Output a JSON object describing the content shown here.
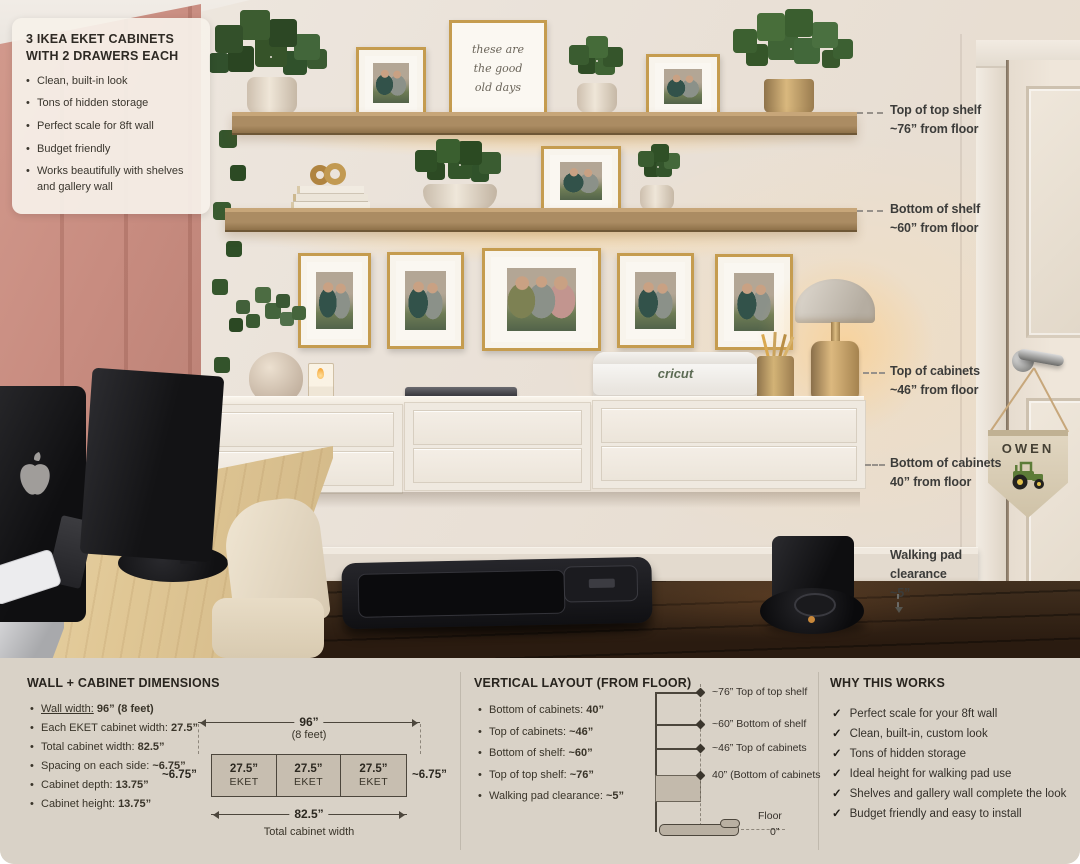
{
  "info_card": {
    "title": "3 IKEA EKET CABINETS WITH 2 DRAWERS EACH",
    "bullets": [
      "Clean, built-in look",
      "Tons of hidden storage",
      "Perfect scale for 8ft wall",
      "Budget friendly",
      "Works beautifully with shelves and gallery wall"
    ]
  },
  "annotations": {
    "top_shelf": {
      "line1": "Top of top shelf",
      "line2": "~76” from floor"
    },
    "bottom_shelf": {
      "line1": "Bottom of shelf",
      "line2": "~60” from floor"
    },
    "top_cabinets": {
      "line1": "Top of cabinets",
      "line2": "~46” from floor"
    },
    "bottom_cabinets": {
      "line1": "Bottom of cabinets",
      "line2": "40” from floor"
    },
    "walking_pad": {
      "line1": "Walking pad",
      "line2": "clearance",
      "line3": "~5”"
    }
  },
  "photo": {
    "quote_print": {
      "line1": "these are",
      "line2": "the good",
      "line3": "old days"
    },
    "pennant_name": "OWEN",
    "cricut_label": "cricut"
  },
  "wall_section": {
    "title": "WALL + CABINET DIMENSIONS",
    "bullets": [
      {
        "label": "Wall width:",
        "value": "96” (8 feet)"
      },
      {
        "label": "Each EKET cabinet width:",
        "value": "27.5”"
      },
      {
        "label": "Total cabinet width:",
        "value": "82.5”"
      },
      {
        "label": "Spacing on each side:",
        "value": "~6.75”"
      },
      {
        "label": "Cabinet depth:",
        "value": "13.75”"
      },
      {
        "label": "Cabinet height:",
        "value": "13.75”"
      }
    ],
    "diagram": {
      "overall_width": "96”",
      "overall_sub": "(8 feet)",
      "left_spacing": "~6.75”",
      "right_spacing": "~6.75”",
      "cabinet_width": "27.5”",
      "cabinet_name": "EKET",
      "total_width": "82.5”",
      "total_caption": "Total cabinet width"
    }
  },
  "vertical_section": {
    "title": "VERTICAL LAYOUT (FROM FLOOR)",
    "bullets": [
      {
        "label": "Bottom of cabinets:",
        "value": "40”"
      },
      {
        "label": "Top of cabinets:",
        "value": "~46”"
      },
      {
        "label": "Bottom of shelf:",
        "value": "~60”"
      },
      {
        "label": "Top of top shelf:",
        "value": "~76”"
      },
      {
        "label": "Walking pad clearance:",
        "value": "~5”"
      }
    ],
    "diagram": {
      "labels": [
        "~76” Top of top shelf",
        "~60” Bottom of shelf",
        "~46” Top of cabinets",
        "40” (Bottom of cabinets"
      ],
      "floor_label": "Floor",
      "floor_value": "0”"
    }
  },
  "why_section": {
    "title": "WHY THIS WORKS",
    "check": "✓",
    "items": [
      "Perfect scale for your 8ft wall",
      "Clean, built-in, custom look",
      "Tons of hidden storage",
      "Ideal height for walking pad use",
      "Shelves and gallery wall complete the look",
      "Budget friendly and easy to install"
    ]
  },
  "colors": {
    "pink_wall": "#c88c80",
    "shelf_wood": "#ab8c63",
    "panel_bg": "#d9d2c7",
    "cabinet_white": "#efe9e0",
    "gold_frame": "#c59c4f",
    "tractor_green": "#5d7c38"
  }
}
